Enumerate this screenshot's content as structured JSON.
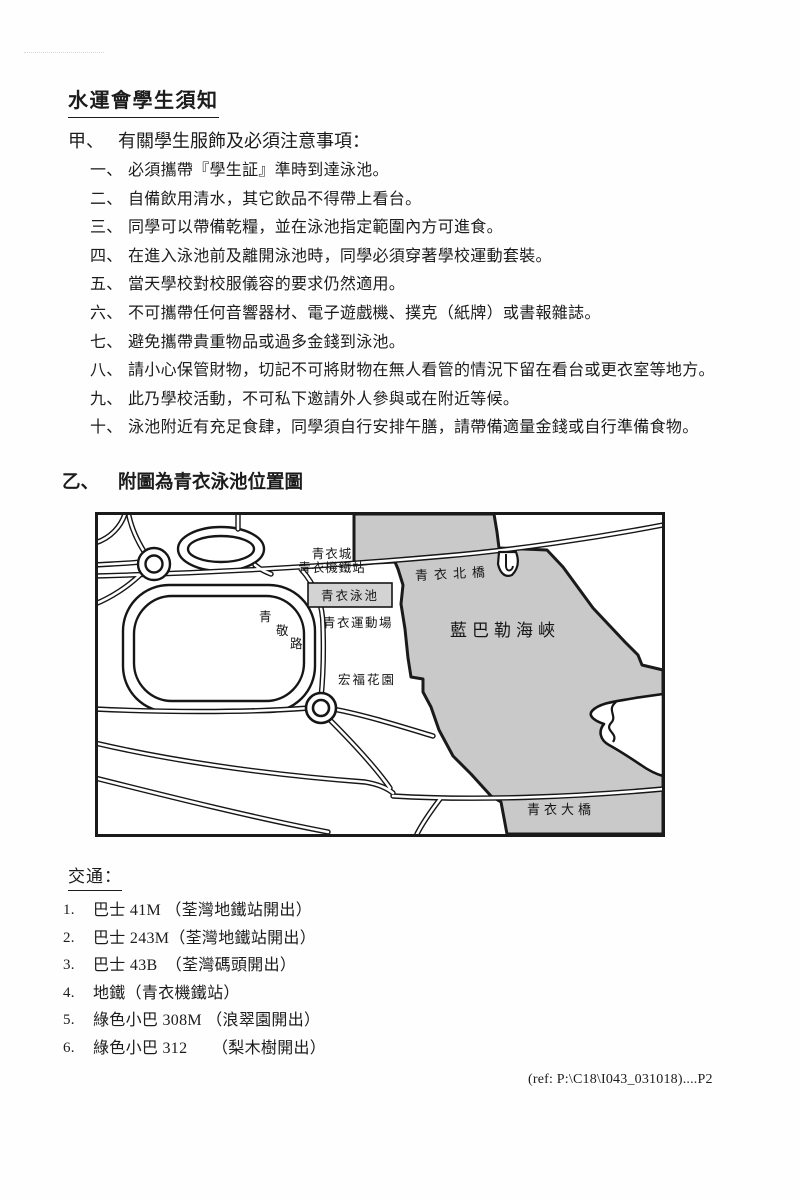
{
  "page": {
    "title": "水運會學生須知",
    "footer_ref": "(ref: P:\\C18\\I043_031018)....P2"
  },
  "section_a": {
    "marker": "甲、",
    "heading": "有關學生服飾及必須注意事項：",
    "items": [
      {
        "num": "一、",
        "text": "必須攜帶『學生証』準時到達泳池。"
      },
      {
        "num": "二、",
        "text": "自備飲用清水，其它飲品不得帶上看台。"
      },
      {
        "num": "三、",
        "text": "同學可以帶備乾糧，並在泳池指定範圍內方可進食。"
      },
      {
        "num": "四、",
        "text": "在進入泳池前及離開泳池時，同學必須穿著學校運動套裝。"
      },
      {
        "num": "五、",
        "text": "當天學校對校服儀容的要求仍然適用。"
      },
      {
        "num": "六、",
        "text": "不可攜帶任何音響器材、電子遊戲機、撲克（紙牌）或書報雜誌。"
      },
      {
        "num": "七、",
        "text": "避免攜帶貴重物品或過多金錢到泳池。"
      },
      {
        "num": "八、",
        "text": "請小心保管財物，切記不可將財物在無人看管的情況下留在看台或更衣室等地方。"
      },
      {
        "num": "九、",
        "text": "此乃學校活動，不可私下邀請外人參與或在附近等候。"
      },
      {
        "num": "十、",
        "text": "泳池附近有充足食肆，同學須自行安排午膳，請帶備適量金錢或自行準備食物。"
      }
    ]
  },
  "section_b": {
    "marker": "乙、",
    "heading": "附圖為青衣泳池位置圖"
  },
  "map": {
    "labels": {
      "city_line1": "青衣城",
      "city_line2": "青衣機鐵站",
      "north_bridge": "青衣北橋",
      "pool": "青衣泳池",
      "sports_ground": "青衣運動場",
      "road_char1": "青",
      "road_char2": "敬",
      "road_char3": "路",
      "garden": "宏福花園",
      "channel": "藍巴勒海峽",
      "south_bridge": "青衣大橋"
    },
    "sea_color": "#c9c9c9",
    "pool_box_color": "#d3d3d3",
    "ink_color": "#161616"
  },
  "transport": {
    "heading": "交通：",
    "items": [
      {
        "num": "1.",
        "text": "巴士 41M （荃灣地鐵站開出）"
      },
      {
        "num": "2.",
        "text": "巴士 243M（荃灣地鐵站開出）"
      },
      {
        "num": "3.",
        "text": "巴士 43B　（荃灣碼頭開出）"
      },
      {
        "num": "4.",
        "text": "地鐵（青衣機鐵站）"
      },
      {
        "num": "5.",
        "text": "綠色小巴 308M （浪翠園開出）"
      },
      {
        "num": "6.",
        "text": "綠色小巴 312　　（梨木樹開出）"
      }
    ]
  }
}
